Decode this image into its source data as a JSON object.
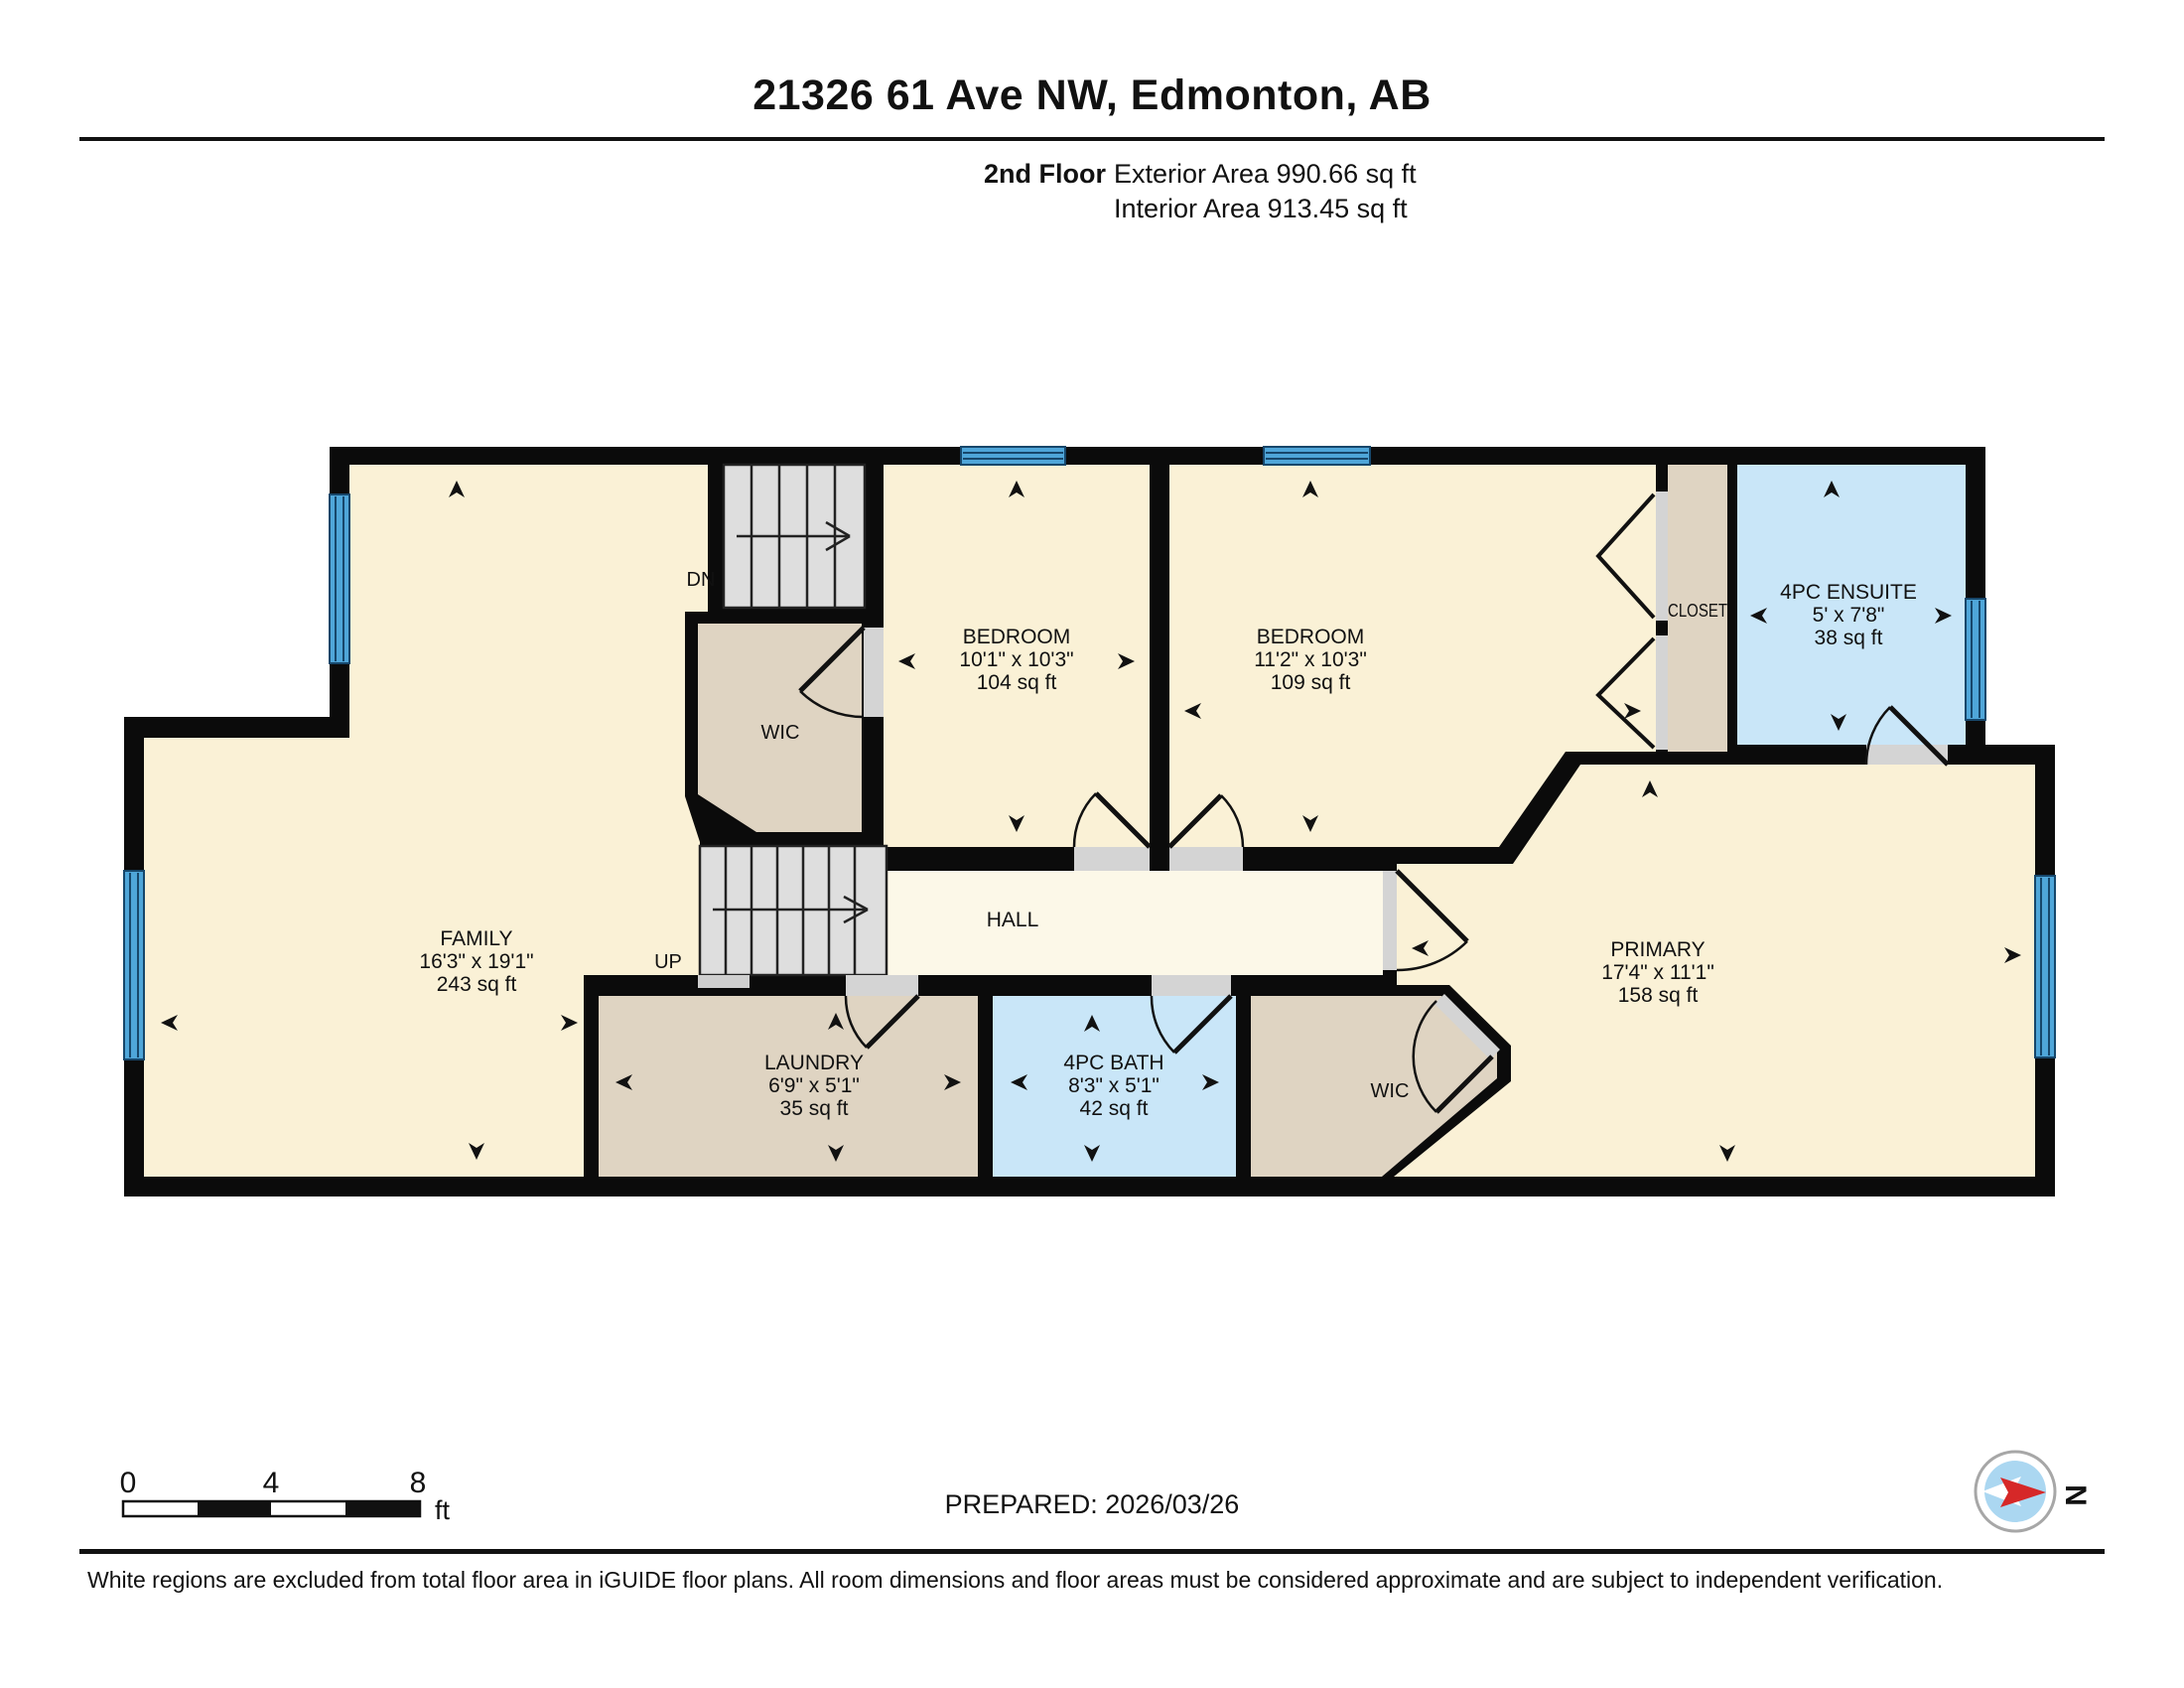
{
  "header": {
    "title": "21326 61 Ave NW, Edmonton, AB",
    "floor_label": "2nd Floor",
    "exterior_area": "Exterior Area 990.66 sq ft",
    "interior_area": "Interior Area 913.45 sq ft"
  },
  "rooms": {
    "family": {
      "name": "FAMILY",
      "dims": "16'3\" x 19'1\"",
      "area": "243 sq ft"
    },
    "bedroom1": {
      "name": "BEDROOM",
      "dims": "10'1\" x 10'3\"",
      "area": "104 sq ft"
    },
    "bedroom2": {
      "name": "BEDROOM",
      "dims": "11'2\" x 10'3\"",
      "area": "109 sq ft"
    },
    "closet": {
      "name": "CLOSET"
    },
    "ensuite": {
      "name": "4PC ENSUITE",
      "dims": "5' x 7'8\"",
      "area": "38 sq ft"
    },
    "primary": {
      "name": "PRIMARY",
      "dims": "17'4\" x 11'1\"",
      "area": "158 sq ft"
    },
    "hall": {
      "name": "HALL"
    },
    "wic_upper": {
      "name": "WIC"
    },
    "wic_primary": {
      "name": "WIC"
    },
    "laundry": {
      "name": "LAUNDRY",
      "dims": "6'9\" x 5'1\"",
      "area": "35 sq ft"
    },
    "bath": {
      "name": "4PC BATH",
      "dims": "8'3\" x 5'1\"",
      "area": "42 sq ft"
    }
  },
  "stairs": {
    "down_label": "DN",
    "up_label": "UP"
  },
  "scale_bar": {
    "tick0": "0",
    "tick4": "4",
    "tick8": "8",
    "unit": "ft"
  },
  "prepared_label": "PREPARED: 2026/03/26",
  "compass": {
    "north_label": "N"
  },
  "footer": {
    "disclaimer": "White regions are excluded from total floor area in iGUIDE floor plans. All room dimensions and floor areas must be considered approximate and are subject to independent verification."
  },
  "colors": {
    "room_cream": "#FAF1D6",
    "hall_cream": "#FCF8E8",
    "tan": "#DFD4C2",
    "room_blue": "#C9E6F8",
    "window_blue": "#4FA6D9",
    "stair_grey": "#DEDEDE",
    "threshold_grey": "#D4D4D4",
    "wall_black": "#0B0B0B",
    "compass_red": "#D62828",
    "compass_blue": "#ABD7F1"
  }
}
